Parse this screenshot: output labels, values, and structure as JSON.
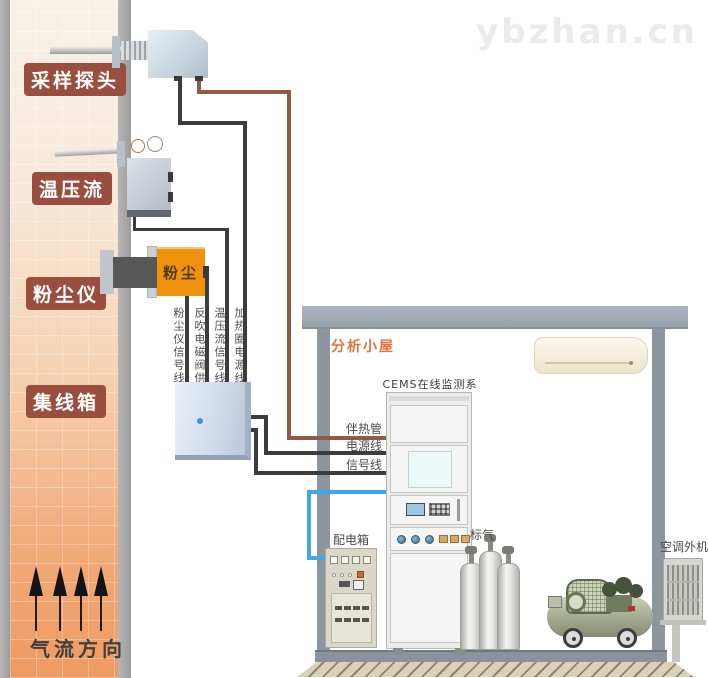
{
  "watermark": "ybzhan.cn",
  "stack": {
    "label_sampling_probe": "采样探头",
    "label_temp_pressure_flow": "温压流",
    "label_dust_meter": "粉尘仪",
    "label_junction_box": "集线箱",
    "airflow_direction": "气流方向",
    "dust_meter_badge": "粉尘"
  },
  "wires": {
    "vertical_labels": [
      "粉尘仪信号线",
      "反吹电磁阀供电线",
      "温压流信号线",
      "加热圈电源线"
    ],
    "heat_traced_tube": "伴热管",
    "power_line": "电源线",
    "signal_line": "信号线"
  },
  "room": {
    "title": "分析小屋",
    "cems_system": "CEMS在线监测系统",
    "power_distribution_box": "配电箱",
    "standard_gas": "标气",
    "outdoor_ac_unit": "空调外机"
  },
  "colors": {
    "tag_background": "#9a4f3e",
    "room_title": "#e8703c",
    "heat_tube_wire": "#8f5a47",
    "signal_power_wire": "#3c3c3c",
    "sample_tube_wire": "#3fa9e6",
    "dust_meter_body": "#f1920e",
    "chimney_bottom": "#ee9a60",
    "structure_gray": "#96a0a8"
  }
}
